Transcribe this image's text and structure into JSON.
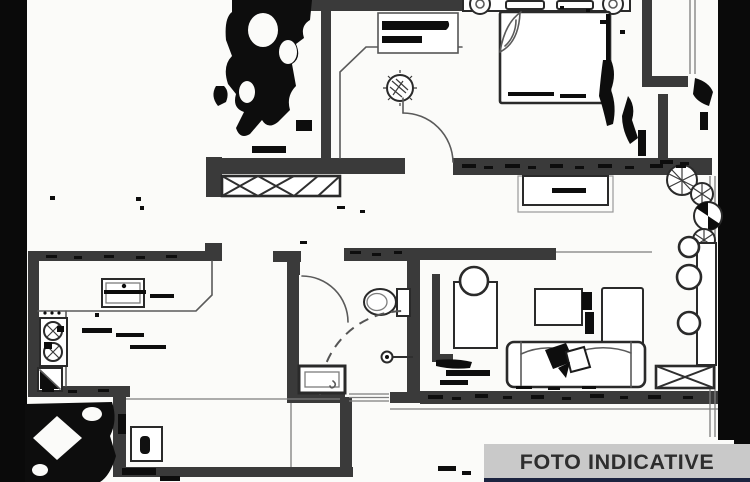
{
  "banner": {
    "label": "FOTO INDICATIVE"
  },
  "colors": {
    "paper": "#fbfbf9",
    "ink": "#2a2a2a",
    "wall": "#3a3a3a",
    "line": "#5a5a5a",
    "banner_bg": "#c9c9c9",
    "banner_text": "#2e2e2e",
    "footer_strip": "#1c2440",
    "bar": "#0a0a0a"
  },
  "plan": {
    "fixtures": [
      "double-bed",
      "pillows",
      "bedside-lamps",
      "entry-hall-fixture",
      "door-swings",
      "wardrobe",
      "radiator-x-boxes",
      "kitchen-sink",
      "cooktop",
      "corner-cabinet",
      "counter",
      "toilet",
      "shower-enclosure",
      "washbasin-vanity",
      "sofa",
      "throw-pillows",
      "coffee-table",
      "desk",
      "desk-chair",
      "sideboard",
      "dining-table",
      "dining-chairs",
      "potted-plants",
      "balcony-railing",
      "balcony-window",
      "scan-blobs"
    ]
  }
}
